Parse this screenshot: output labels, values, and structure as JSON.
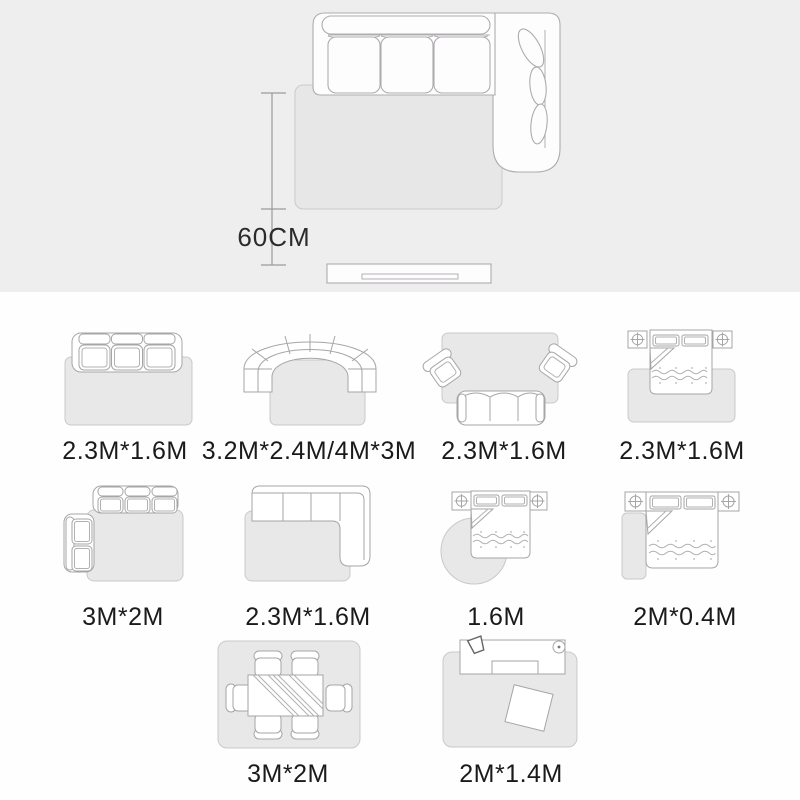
{
  "hero": {
    "distance_label": "60CM"
  },
  "items": [
    {
      "name": "three-seat-sofa-rug",
      "label": "2.3M*1.6M"
    },
    {
      "name": "curved-sofa-rug",
      "label": "3.2M*2.4M/4M*3M"
    },
    {
      "name": "sofa-armchairs-rug",
      "label": "2.3M*1.6M"
    },
    {
      "name": "bed-rug",
      "label": "2.3M*1.6M"
    },
    {
      "name": "corner-sofa-left-rug",
      "label": "3M*2M"
    },
    {
      "name": "chaise-sofa-rug",
      "label": "2.3M*1.6M"
    },
    {
      "name": "bed-round-rug",
      "label": "1.6M"
    },
    {
      "name": "bed-runner-rug",
      "label": "2M*0.4M"
    },
    {
      "name": "dining-table-rug",
      "label": "3M*2M"
    },
    {
      "name": "desk-rug",
      "label": "2M*1.4M"
    }
  ],
  "colors": {
    "panel_bg": "#efeeef",
    "page_bg": "#fefefe",
    "rug_fill": "#e9e8e9",
    "rug_stroke": "#c9c9c9",
    "furniture_stroke": "#a6a6a6",
    "text": "#1a1a1a"
  }
}
